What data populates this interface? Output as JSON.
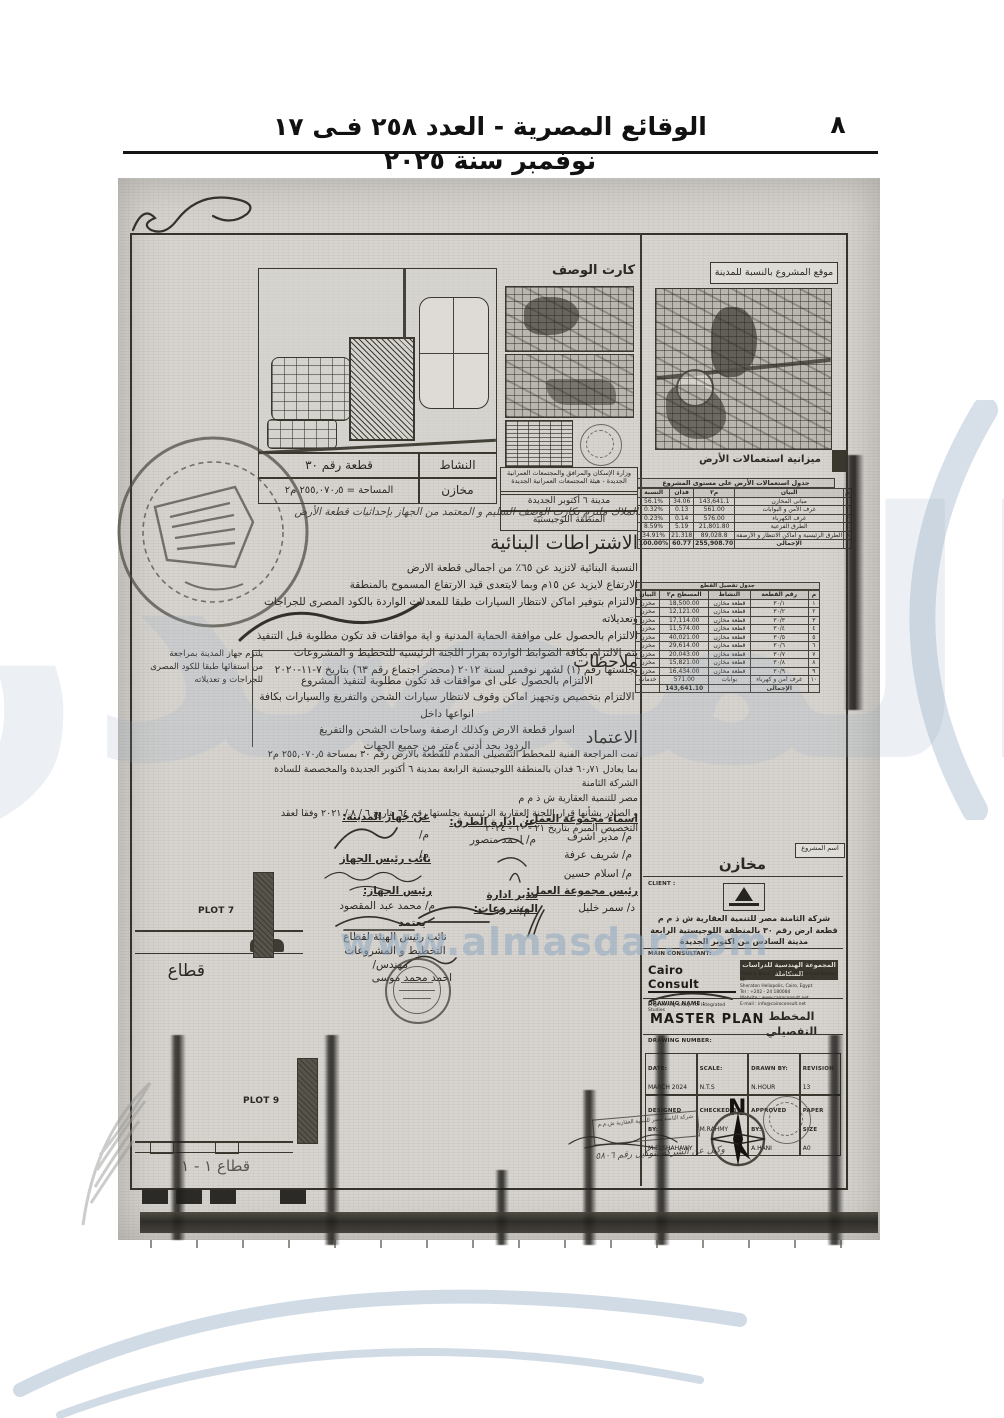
{
  "header": {
    "gazette_title": "الوقائع المصرية - العدد ٢٥٨ فـى ١٧ نوفمبر سنة ٢٠٢٥",
    "page_number": "٨"
  },
  "watermark": {
    "big_text": "المصدر",
    "site_text": "www.almasdar.com"
  },
  "key_plan": {
    "plot_no_label": "قطعة رقم ٣٠",
    "area_label": "المساحة = ٢٥٥,٠٧٠٫٥ م٢",
    "activity_label": "النشاط",
    "activity_value": "مخازن"
  },
  "desc_card": {
    "title": "كارت الوصف",
    "ministry": "وزارة الإسكان والمرافق والمجتمعات العمرانية الجديدة - هيئة المجتمعات العمرانية الجديدة",
    "city": "مدينة ٦ أكتوبر الجديدة",
    "zone": "المنطقة اللوجيستية"
  },
  "location_map": {
    "title": "موقع المشروع بالنسبة للمدينة",
    "budget_label": "ميزانية استعمالات الأرض"
  },
  "land_use_table": {
    "title": "جدول استعمالات الأرض على مستوى المشروع",
    "headers": [
      "م",
      "البيان",
      "م٢",
      "فدان",
      "النسبة"
    ],
    "rows": [
      [
        "١",
        "مبانى المخازن",
        "143,641.1",
        "34.06",
        "56.1%"
      ],
      [
        "٢",
        "غرف الأمن و البوابات",
        "561.00",
        "0.13",
        "0.32%"
      ],
      [
        "٣",
        "غرف الكهرباء",
        "576.00",
        "0.14",
        "0.23%"
      ],
      [
        "٤",
        "الطرق الفرعية",
        "21,801.80",
        "5.19",
        "8.59%"
      ],
      [
        "٥",
        "الطرق الرئيسية و أماكن الانتظار و الأرصفة",
        "89,028.8",
        "21.318",
        "34.91%"
      ]
    ],
    "total_row": [
      "",
      "الإجمالى",
      "255,908.70",
      "60.77",
      "100.00%"
    ]
  },
  "plots_table": {
    "title": "جدول تفصيل القطع",
    "headers": [
      "م",
      "رقم القطعة",
      "النشاط",
      "المسطح م٢",
      "البيان"
    ],
    "rows": [
      [
        "١",
        "٣٠/١",
        "قطعة مخازن",
        "18,500.00",
        "مخزن"
      ],
      [
        "٢",
        "٣٠/٢",
        "قطعة مخازن",
        "12,121.00",
        "مخزن"
      ],
      [
        "٣",
        "٣٠/٣",
        "قطعة مخازن",
        "17,114.00",
        "مخزن"
      ],
      [
        "٤",
        "٣٠/٤",
        "قطعة مخازن",
        "11,574.00",
        "مخزن"
      ],
      [
        "٥",
        "٣٠/٥",
        "قطعة مخازن",
        "40,021.00",
        "مخزن"
      ],
      [
        "٦",
        "٣٠/٦",
        "قطعة مخازن",
        "29,614.00",
        "مخزن"
      ],
      [
        "٧",
        "٣٠/٧",
        "قطعة مخازن",
        "20,043.00",
        "مخزن"
      ],
      [
        "٨",
        "٣٠/٨",
        "قطعة مخازن",
        "15,821.00",
        "مخزن"
      ],
      [
        "٩",
        "٣٠/٩",
        "قطعة مخازن",
        "16,434.00",
        "مخزن"
      ],
      [
        "١٠",
        "غرف أمن و كهرباء",
        "بوابات",
        "571.00",
        "خدمات"
      ]
    ],
    "total_row": [
      "",
      "الإجمالى",
      "",
      "143,641.10",
      ""
    ]
  },
  "intro_line": "الملاك ملتزم بكارت الوصف السليم و المعتمد من الجهاز بإحداثيات قطعة الأرض",
  "conditions": {
    "heading": "الاشتراطات البنائية",
    "lines": [
      "النسبة البنائية لاتزيد عن ٦٥٪ من اجمالى قطعة الارض",
      "الارتفاع لايزيد عن ١٥م وبما لايتعدى قيد الارتفاع المسموح بالمنطقة",
      "الالتزام بتوفير اماكن لانتظار السيارات طبقا للمعدلات الواردة بالكود المصرى للجراجات وتعديلاته",
      "الالتزام بالحصول على موافقة الحماية المدنية و اية موافقات قد تكون مطلوبة قبل التنفيذ",
      "يتم الالتزام بكافة الضوابط الوارده بقرار اللجنة الرئيسية للتخطيط و المشروعات",
      "بجلستها رقم (١) لشهر نوفمبر لسنة ٢٠١٢ (محضر اجتماع رقم ٦٣) بتاريخ ٧-١١-٢٠٢٠"
    ]
  },
  "notes": {
    "heading": "ملاحظات",
    "lines": [
      "الالتزام بالحصول على اى موافقات قد تكون مطلوبة لتنفيذ المشروع",
      "الالتزام بتخصيص وتجهيز اماكن وقوف لانتظار سيارات الشحن والتفريغ والسيارات بكافة انواعها داخل",
      "اسوار قطعة الارض وكذلك ارصفة وساحات الشحن والتفريغ",
      "الردود بحد أدنى ٤متر من جميع الجهات"
    ]
  },
  "approval": {
    "heading": "الاعتماد",
    "lines": [
      "تمت المراجعة الفنية للمخطط التفصيلى المقدم للقطعة بالارض رقم ٣٠ بمساحة  ٢٥٥,٠٧٠٫٥ م٢",
      "بما يعادل ٦٠٫٧١ فدان بالمنطقة اللوجيستية الرابعة بمدينة ٦ أكتوبر الجديدة والمخصصة للسادة الشركة الثامنة",
      "مصر للتنمية العقارية ش ذ م م",
      "و الصادر بشأنها قرار اللجنة العقارية الرئيسية بجلستها رقم ٦٤    بتاريخ    ٦ / ٨ / ٢٠٢١ وفقا لعقد",
      "التخصيص المبرم بتاريخ ٢١ - ١٠ - ٢٠٢٤"
    ]
  },
  "signatures": {
    "work_group_label": "اسماء مجموعة العمل:",
    "work_group_names": [
      "م/ مدير اشرف",
      "م/ شريف عرفة",
      "م/ اسلام حسين"
    ],
    "roads_label": "عن ادارة الطرق:",
    "roads_name": "م/ احمد منصور",
    "city_agency_label": "عن جهاز المدينة:",
    "city_agency_names": [
      "م/",
      "م/"
    ],
    "deputy_head_label": "نائب رئيس الجهاز",
    "group_head_label": "رئيس مجموعة العمل:",
    "group_head_name": "د/ سمر خليل",
    "projects_dir_label": "مدير ادارة المشروعات:",
    "projects_dir_name": "م/",
    "agency_head_label": "رئيس الجهاز:",
    "agency_head_name": "م/ محمد عبد المقصود",
    "approve_label": "يعتمد",
    "approve_title1": "نائب رئيس الهيئة لقطاع",
    "approve_title2": "التخطيط و المشروعات",
    "approve_prefix": "مهندس/",
    "approve_name": "احمد محمد موسى"
  },
  "stamp_note_lines": [
    "يلتزم جهاز المدينة بمراجعة",
    "من استفائها طبقا للكود المصرى",
    "للجراجات و تعديلاته"
  ],
  "sections_left": {
    "plot7": "PLOT 7",
    "plot9": "PLOT 9",
    "section_label": "قطاع",
    "section_1_1": "قطاع ١ - ١"
  },
  "title_block": {
    "project_name_label": "اسم المشروع",
    "project_name": "مخازن",
    "client_label": "CLIENT :",
    "client_lines": [
      "شركة الثامنة مصر للتنمية العقارية ش ذ م م",
      "قطعة ارض رقم ٣٠ بالمنطقة اللوجيستية الرابعة",
      "مدينة السادس من اكتوبر الجديدة"
    ],
    "consultant_label": "MAIN CONSULTANT:",
    "consultant_name": "Cairo Consult",
    "consultant_tagline": "Engineering Group For Integrated Studies",
    "consultant_arabic": "المجموعة الهندسية للدراسات المتكاملة",
    "consultant_address": [
      "Plaza 4, Block 1123, Abd El Hameed Badawi St.",
      "Sheraton Heliopolis, Cairo, Egypt",
      "Tel : +202 - 24 180084",
      "Website : www.cairoconsult.net",
      "E-mail : info@cairoconsult.net"
    ],
    "drawing_name_label": "DRAWING NAME :",
    "drawing_name_en": "MASTER PLAN",
    "drawing_name_ar": "المخطط التفصيلي",
    "drawing_number_label": "DRAWING NUMBER:",
    "info": {
      "date_label": "DATE:",
      "date": "MARCH 2024",
      "scale_label": "SCALE:",
      "scale": "N.T.S",
      "drawn_label": "DRAWN BY:",
      "drawn": "N.HOUR",
      "revision_label": "REVISION",
      "revision": "13",
      "designed_label": "DESIGNED BY:",
      "designed": "M.ELSHAHAWY",
      "checked_label": "CHECKED BY:",
      "checked": "M.RAHMY",
      "approved_label": "APPROVED BY:",
      "approved": "A.HANI",
      "paper_label": "PAPER SIZE",
      "paper": "A0"
    },
    "compass_n": "N",
    "agent_stamp": "شركة الثامنة مصر للتنمية العقارية ش.م.م",
    "agent_note": "وكيل عن الشركة بتوكيل رقم ٥٨٠٦"
  },
  "colors": {
    "scan_bg": "#d7d4d0",
    "ink": "#2b2822",
    "watermark_blue": "#8fa8c0"
  }
}
